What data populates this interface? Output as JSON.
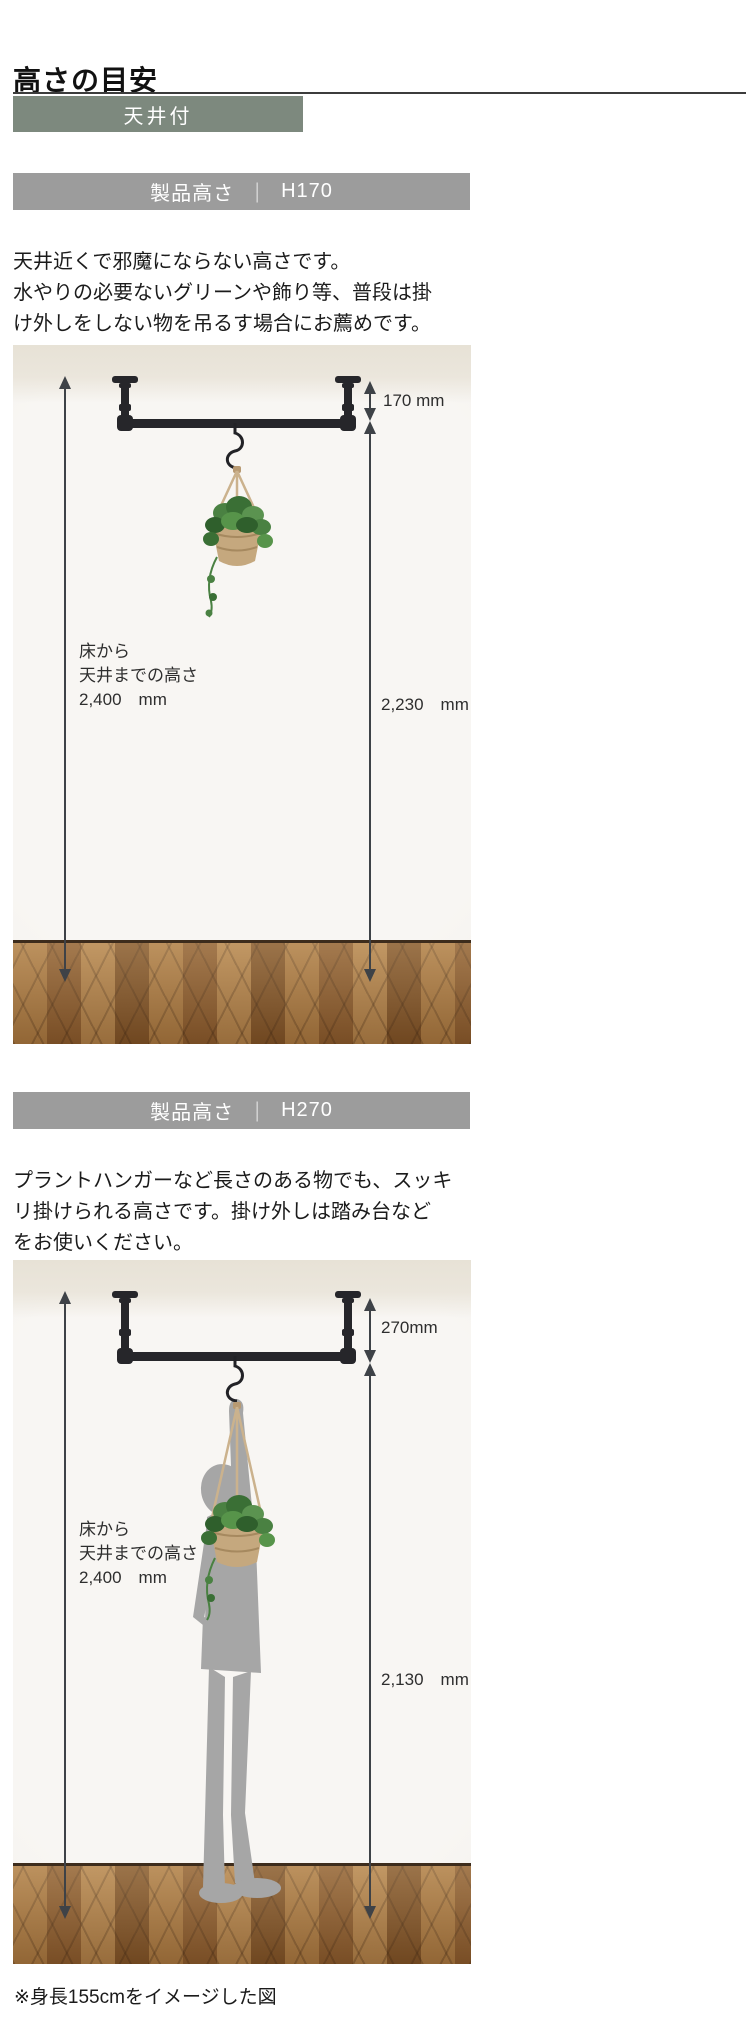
{
  "page": {
    "title": "高さの目安",
    "footnote": "※身長155cmをイメージした図"
  },
  "tag": {
    "label": "天井付"
  },
  "sections": [
    {
      "header": {
        "label": "製品高さ",
        "separator": "｜",
        "value": "H170"
      },
      "description": {
        "line1": "天井近くで邪魔にならない高さです。",
        "line2": "水やりの必要ないグリーンや飾り等、普段は掛",
        "line3": "け外しをしない物を吊るす場合にお薦めです。"
      },
      "figure": {
        "floor_label_line1": "床から",
        "floor_label_line2": "天井までの高さ",
        "floor_label_line3": "2,400　mm",
        "product_height": "170 mm",
        "hang_height": "2,230　mm"
      }
    },
    {
      "header": {
        "label": "製品高さ",
        "separator": "｜",
        "value": "H270"
      },
      "description": {
        "line1": "プラントハンガーなど長さのある物でも、スッキ",
        "line2": "リ掛けられる高さです。掛け外しは踏み台など",
        "line3": "をお使いください。"
      },
      "figure": {
        "floor_label_line1": "床から",
        "floor_label_line2": "天井までの高さ",
        "floor_label_line3": "2,400　mm",
        "product_height": "270mm",
        "hang_height": "2,130　mm"
      }
    }
  ],
  "colors": {
    "accent_sage": "#7d897e",
    "bar_gray": "#9c9c9c",
    "silhouette_gray": "#a6a6a6",
    "wood_brown": "#9a6a38",
    "pipe_black": "#26262a",
    "rope_tan": "#cbb28d",
    "leaf_green": "#4a8142"
  }
}
